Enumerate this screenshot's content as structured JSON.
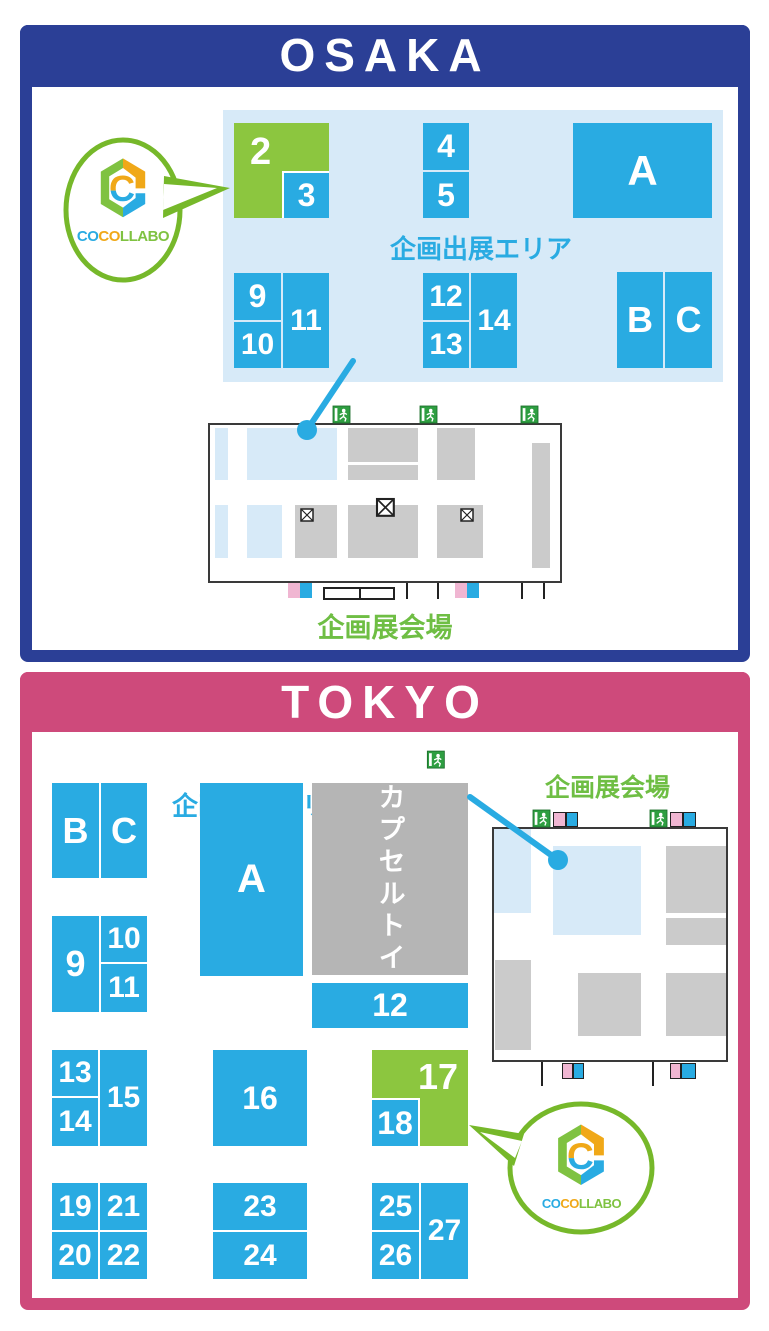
{
  "colors": {
    "booth_blue": "#29abe2",
    "booth_green": "#8cc63f",
    "osaka_navy": "#2b3f96",
    "tokyo_pink": "#ce4a7b",
    "panel_light_blue": "#d7eaf8",
    "map_gray": "#cbcbcb",
    "capsule_gray": "#b5b5b5",
    "door_pink": "#f0b6d2",
    "exit_green": "#2e9e41",
    "hall_text_green": "#6fbe44"
  },
  "osaka": {
    "title": "OSAKA",
    "area_label": "企画出展エリア",
    "hall_label": "企画展会場",
    "booths": {
      "b2": "2",
      "b3": "3",
      "b4": "4",
      "b5": "5",
      "bA": "A",
      "b9": "9",
      "b10": "10",
      "b11": "11",
      "b12": "12",
      "b13": "13",
      "b14": "14",
      "bB": "B",
      "bC": "C"
    }
  },
  "tokyo": {
    "title": "TOKYO",
    "area_label": "企画出展エリア",
    "hall_label": "企画展会場",
    "capsule_label": "カプセルトイ",
    "booths": {
      "bB": "B",
      "bC": "C",
      "b9": "9",
      "b10": "10",
      "b11": "11",
      "bA": "A",
      "b12": "12",
      "b13": "13",
      "b14": "14",
      "b15": "15",
      "b16": "16",
      "b17": "17",
      "b18": "18",
      "b19": "19",
      "b20": "20",
      "b21": "21",
      "b22": "22",
      "b23": "23",
      "b24": "24",
      "b25": "25",
      "b26": "26",
      "b27": "27"
    }
  },
  "logo": {
    "mark_letter": "C",
    "part1": "CO",
    "part2": "CO",
    "part3": "LLABO"
  }
}
